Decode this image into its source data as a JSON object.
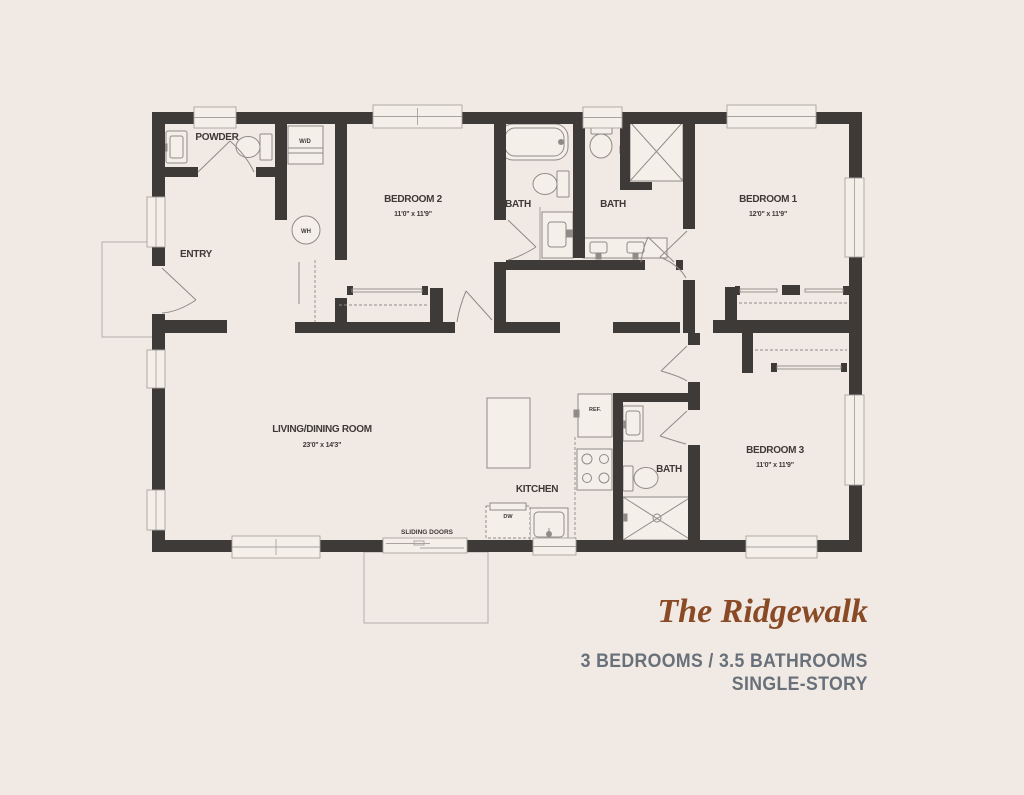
{
  "plan": {
    "rooms": [
      {
        "label": "POWDER"
      },
      {
        "label": "ENTRY"
      },
      {
        "label": "BEDROOM 2",
        "dims": "11'0\" x 11'9\""
      },
      {
        "label": "BATH"
      },
      {
        "label": "BATH"
      },
      {
        "label": "BEDROOM 1",
        "dims": "12'0\" x 11'9\""
      },
      {
        "label": "LIVING/DINING ROOM",
        "dims": "23'0\" x 14'3\""
      },
      {
        "label": "KITCHEN"
      },
      {
        "label": "BATH"
      },
      {
        "label": "BEDROOM 3",
        "dims": "11'0\" x 11'9\""
      }
    ],
    "fixtures": {
      "washer_dryer": "W/D",
      "water_heater": "WH",
      "refrigerator": "REF.",
      "dishwasher": "DW"
    },
    "annotations": {
      "sliding_doors": "SLIDING DOORS"
    }
  },
  "footer": {
    "title": "The Ridgewalk",
    "subtitle_line1": "3 BEDROOMS / 3.5 BATHROOMS",
    "subtitle_line2": "SINGLE-STORY"
  },
  "colors": {
    "background": "#f1eae4",
    "wall": "#3e3a37",
    "fixture_line": "#8f8b87",
    "title_accent": "#8a4a26",
    "subtitle": "#68707a"
  }
}
